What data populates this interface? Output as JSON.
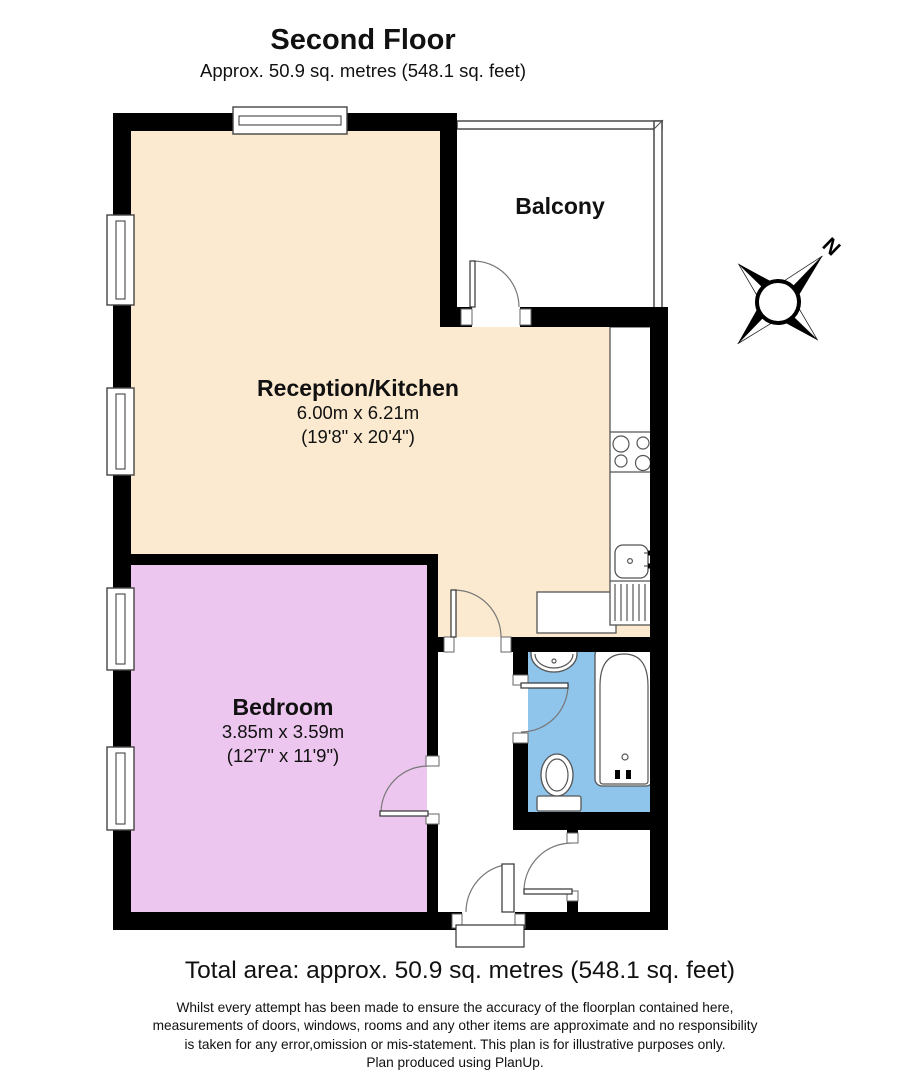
{
  "header": {
    "title": "Second Floor",
    "subtitle": "Approx. 50.9 sq. metres (548.1 sq. feet)"
  },
  "rooms": {
    "balcony": {
      "name": "Balcony"
    },
    "reception": {
      "name": "Reception/Kitchen",
      "dimensions_metric": "6.00m x 6.21m",
      "dimensions_imperial": "(19'8\" x 20'4\")"
    },
    "bedroom": {
      "name": "Bedroom",
      "dimensions_metric": "3.85m x 3.59m",
      "dimensions_imperial": "(12'7\" x 11'9\")"
    }
  },
  "compass": {
    "north_label": "N"
  },
  "footer": {
    "total_area": "Total area: approx. 50.9 sq. metres (548.1 sq. feet)",
    "disclaimer_lines": [
      "Whilst every attempt has been made to ensure the accuracy of the floorplan contained here,",
      "measurements of doors, windows, rooms and any other items are approximate and no responsibility",
      "is taken for any error,omission or mis-statement. This plan is for illustrative purposes only.",
      "Plan produced using PlanUp."
    ]
  },
  "colors": {
    "wall": "#000000",
    "outline": "#555555",
    "reception_fill": "#FBEACF",
    "bedroom_fill": "#ECC6EE",
    "bathroom_fill": "#8FC4EB",
    "balcony_fill": "#FFFFFF"
  }
}
